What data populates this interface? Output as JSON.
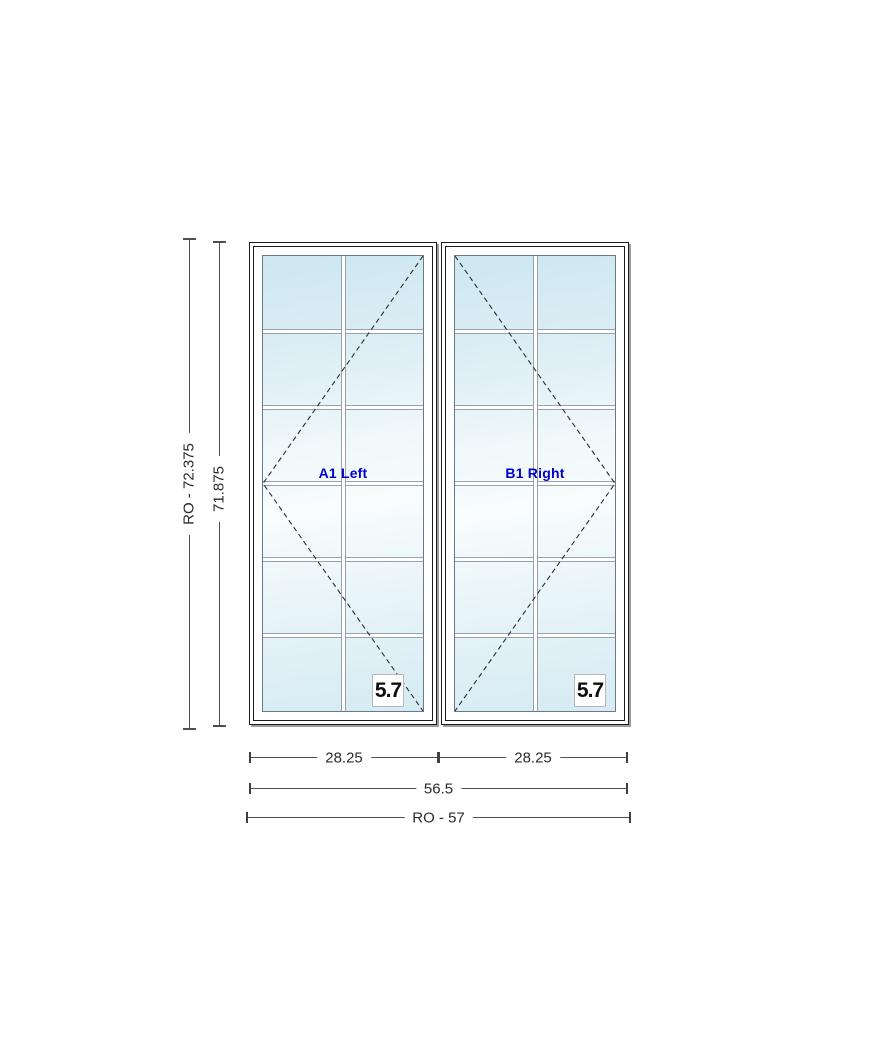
{
  "drawing": {
    "background": "#ffffff",
    "grid": {
      "rows": 6,
      "cols": 2
    }
  },
  "panels": [
    {
      "label": "A1 Left",
      "egress": "5.7",
      "swing": "left"
    },
    {
      "label": "B1 Right",
      "egress": "5.7",
      "swing": "right"
    }
  ],
  "dimensions": {
    "height_ro": "RO - 72.375",
    "height_frame": "71.875",
    "width_left": "28.25",
    "width_right": "28.25",
    "width_total": "56.5",
    "width_ro": "RO - 57"
  },
  "colors": {
    "panel_label_blue": "#0000cd",
    "glass_blue": "#cde7f0",
    "frame_black": "#1b1b1b",
    "frame_shadow_gray": "#9c9c9c",
    "grille_edge_gray": "#98a2ab",
    "dimension_gray": "#4f4f4f"
  }
}
